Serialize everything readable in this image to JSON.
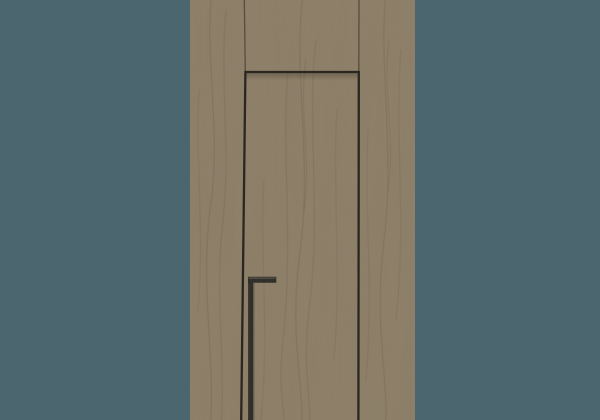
{
  "scene": {
    "subject": "concealed-frame wooden door render",
    "background_color": "#4c666f",
    "wood": {
      "base_color": "#8c7d66",
      "grain_color": "#6f624c",
      "seam_color": "#4e4536"
    },
    "door": {
      "gap_color": "#2a2721"
    },
    "handle": {
      "color": "#312f2a",
      "highlight_color": "#5f5b52"
    }
  }
}
